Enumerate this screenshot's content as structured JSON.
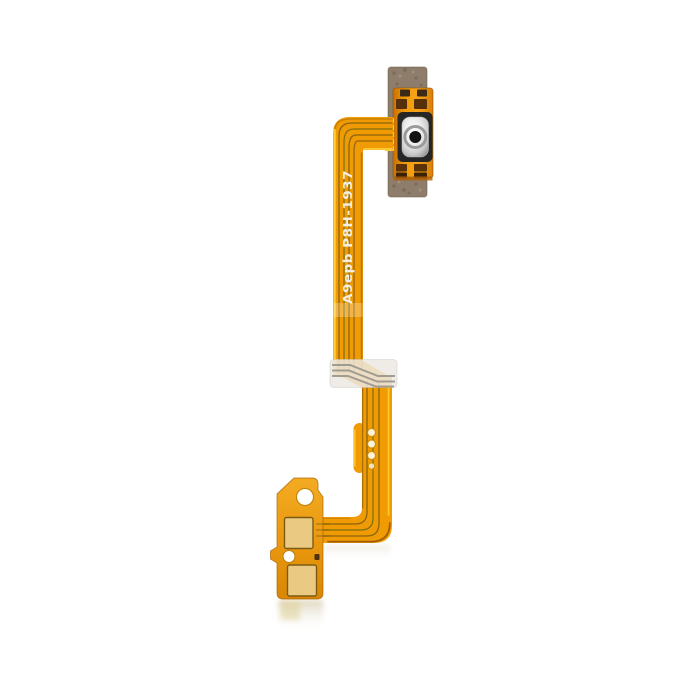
{
  "photo": {
    "background_color": "#ffffff",
    "marking_text": "A9epb P8H-1937",
    "colors": {
      "ribbon_orange": "#f09b04",
      "ribbon_highlight": "#ffd23e",
      "ribbon_edge_dark": "#8a4d00",
      "trace_dark": "#7a5a0e",
      "adhesive_strip": "#8d7d6a",
      "button_pad": "#ee9307",
      "switch_body": "#262626",
      "switch_center": "#141414",
      "stiffener_patch": "#ece9e4",
      "connector_orange": "#eb9d14",
      "contact_pad_gold": "#eaca82",
      "hole_white": "#ffffff",
      "marking_text_color": "#f2eee4"
    }
  }
}
